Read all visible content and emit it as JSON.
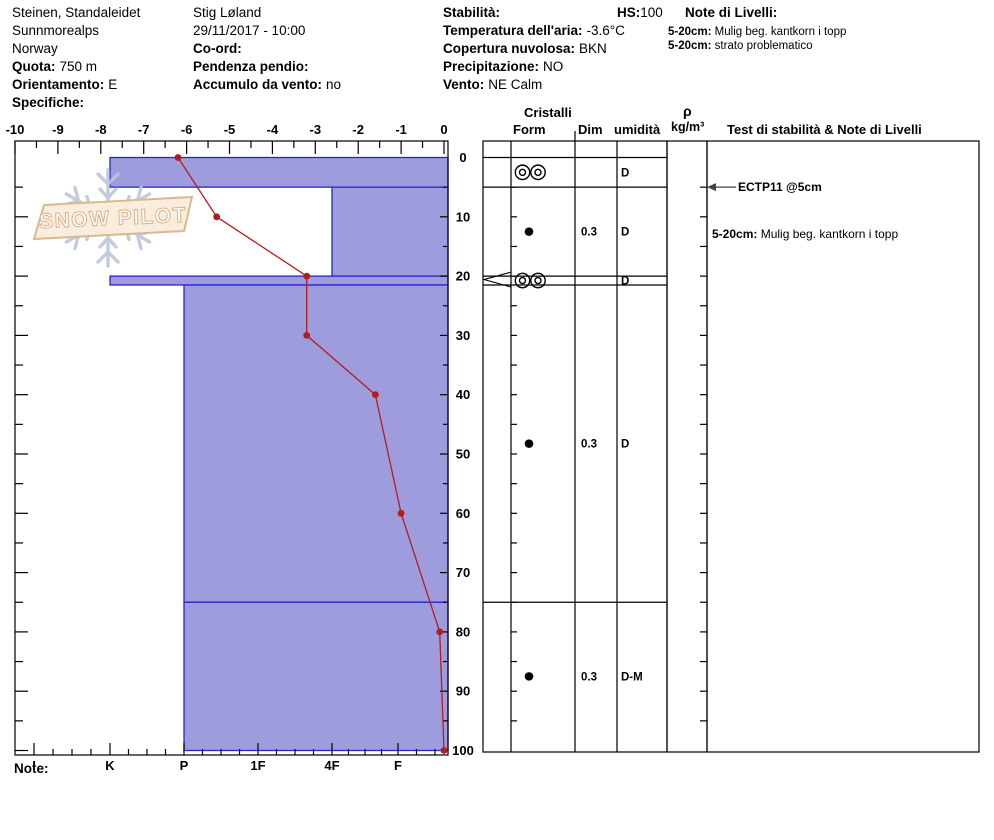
{
  "header": {
    "col1": {
      "location": "Steinen, Standaleidet",
      "range": "Sunnmorealps",
      "country": "Norway",
      "quota_label": "Quota:",
      "quota_value": "750 m",
      "orientamento_label": "Orientamento:",
      "orientamento_value": "E",
      "specifiche_label": "Specifiche:"
    },
    "col2": {
      "observer": "Stig Løland",
      "datetime": "29/11/2017 - 10:00",
      "coord_label": "Co-ord:",
      "pendenza_label": "Pendenza pendio:",
      "accumulo_label": "Accumulo da vento:",
      "accumulo_value": "no"
    },
    "col3": {
      "stabilita_label": "Stabilità:",
      "hs_label": "HS:",
      "hs_value": "100",
      "temp_label": "Temperatura dell'aria:",
      "temp_value": "-3.6°C",
      "copertura_label": "Copertura nuvolosa:",
      "copertura_value": "BKN",
      "precip_label": "Precipitazione:",
      "precip_value": "NO",
      "vento_label": "Vento:",
      "vento_value": "NE Calm"
    },
    "col4": {
      "title": "Note di Livelli:",
      "notes": [
        {
          "range": "5-20cm:",
          "text": "Mulig beg. kantkorn i topp"
        },
        {
          "range": "5-20cm:",
          "text": "strato problematico"
        }
      ]
    }
  },
  "logo": {
    "text": "SNOW PILOT"
  },
  "chart_data": {
    "type": "line",
    "title": "Snow pit profile: temperature (°C) vs depth (cm) over hand-hardness layer bars",
    "temp_axis": {
      "position": "top",
      "min": -10,
      "max": 0,
      "ticks": [
        -10,
        -9,
        -8,
        -7,
        -6,
        -5,
        -4,
        -3,
        -2,
        -1,
        0
      ]
    },
    "depth_axis": {
      "position": "right",
      "min": 0,
      "max": 100,
      "unit": "cm",
      "ticks": [
        0,
        10,
        20,
        30,
        40,
        50,
        60,
        70,
        80,
        90,
        100
      ]
    },
    "hardness_axis": {
      "position": "bottom",
      "categories": [
        "I",
        "K",
        "P",
        "1F",
        "4F",
        "F"
      ]
    },
    "temperature_series": [
      {
        "depth_cm": 0,
        "temp_c": -6.2
      },
      {
        "depth_cm": 10,
        "temp_c": -5.3
      },
      {
        "depth_cm": 20,
        "temp_c": -3.2
      },
      {
        "depth_cm": 30,
        "temp_c": -3.2
      },
      {
        "depth_cm": 40,
        "temp_c": -1.6
      },
      {
        "depth_cm": 60,
        "temp_c": -1.0
      },
      {
        "depth_cm": 80,
        "temp_c": -0.1
      },
      {
        "depth_cm": 100,
        "temp_c": 0.0
      }
    ],
    "layers": [
      {
        "top_cm": 0,
        "bottom_cm": 5,
        "hardness": "K"
      },
      {
        "top_cm": 5,
        "bottom_cm": 20,
        "hardness": "4F"
      },
      {
        "top_cm": 20,
        "bottom_cm": 21.5,
        "hardness": "K"
      },
      {
        "top_cm": 21.5,
        "bottom_cm": 75,
        "hardness": "P"
      },
      {
        "top_cm": 75,
        "bottom_cm": 100,
        "hardness": "P"
      }
    ],
    "colors": {
      "layer_fill": "#9f9cdd",
      "layer_border": "#2b24c6",
      "temp_line": "#b01e1e",
      "axis": "#000000"
    }
  },
  "crystal_table": {
    "title": "Cristalli",
    "columns": {
      "form": "Form",
      "dim": "Dim",
      "humidity": "umidità"
    },
    "rho_symbol": "ρ",
    "rho_unit": "kg/m³",
    "stability_header": "Test di stabilità & Note di Livelli",
    "rows": [
      {
        "top_cm": 0,
        "bottom_cm": 5,
        "form_glyph": "double-circles",
        "form_unicode": "◎◎",
        "dim": "",
        "humidity": "D"
      },
      {
        "top_cm": 5,
        "bottom_cm": 20,
        "form_glyph": "dot",
        "form_unicode": "●",
        "dim": "0.3",
        "humidity": "D"
      },
      {
        "top_cm": 20,
        "bottom_cm": 21.5,
        "form_glyph": "double-circles",
        "form_unicode": "◎◎",
        "dim": "",
        "humidity": "D",
        "flagged": true
      },
      {
        "top_cm": 21.5,
        "bottom_cm": 75,
        "form_glyph": "dot",
        "form_unicode": "●",
        "dim": "0.3",
        "humidity": "D"
      },
      {
        "top_cm": 75,
        "bottom_cm": 100,
        "form_glyph": "dot",
        "form_unicode": "●",
        "dim": "0.3",
        "humidity": "D-M"
      }
    ],
    "stability_test": {
      "label": "ECTP11 @5cm",
      "depth_cm": 5
    },
    "layer_note": {
      "range": "5-20cm:",
      "text": "Mulig beg. kantkorn i topp",
      "depth_cm": 13
    }
  },
  "footer": {
    "note_label": "Note:"
  }
}
